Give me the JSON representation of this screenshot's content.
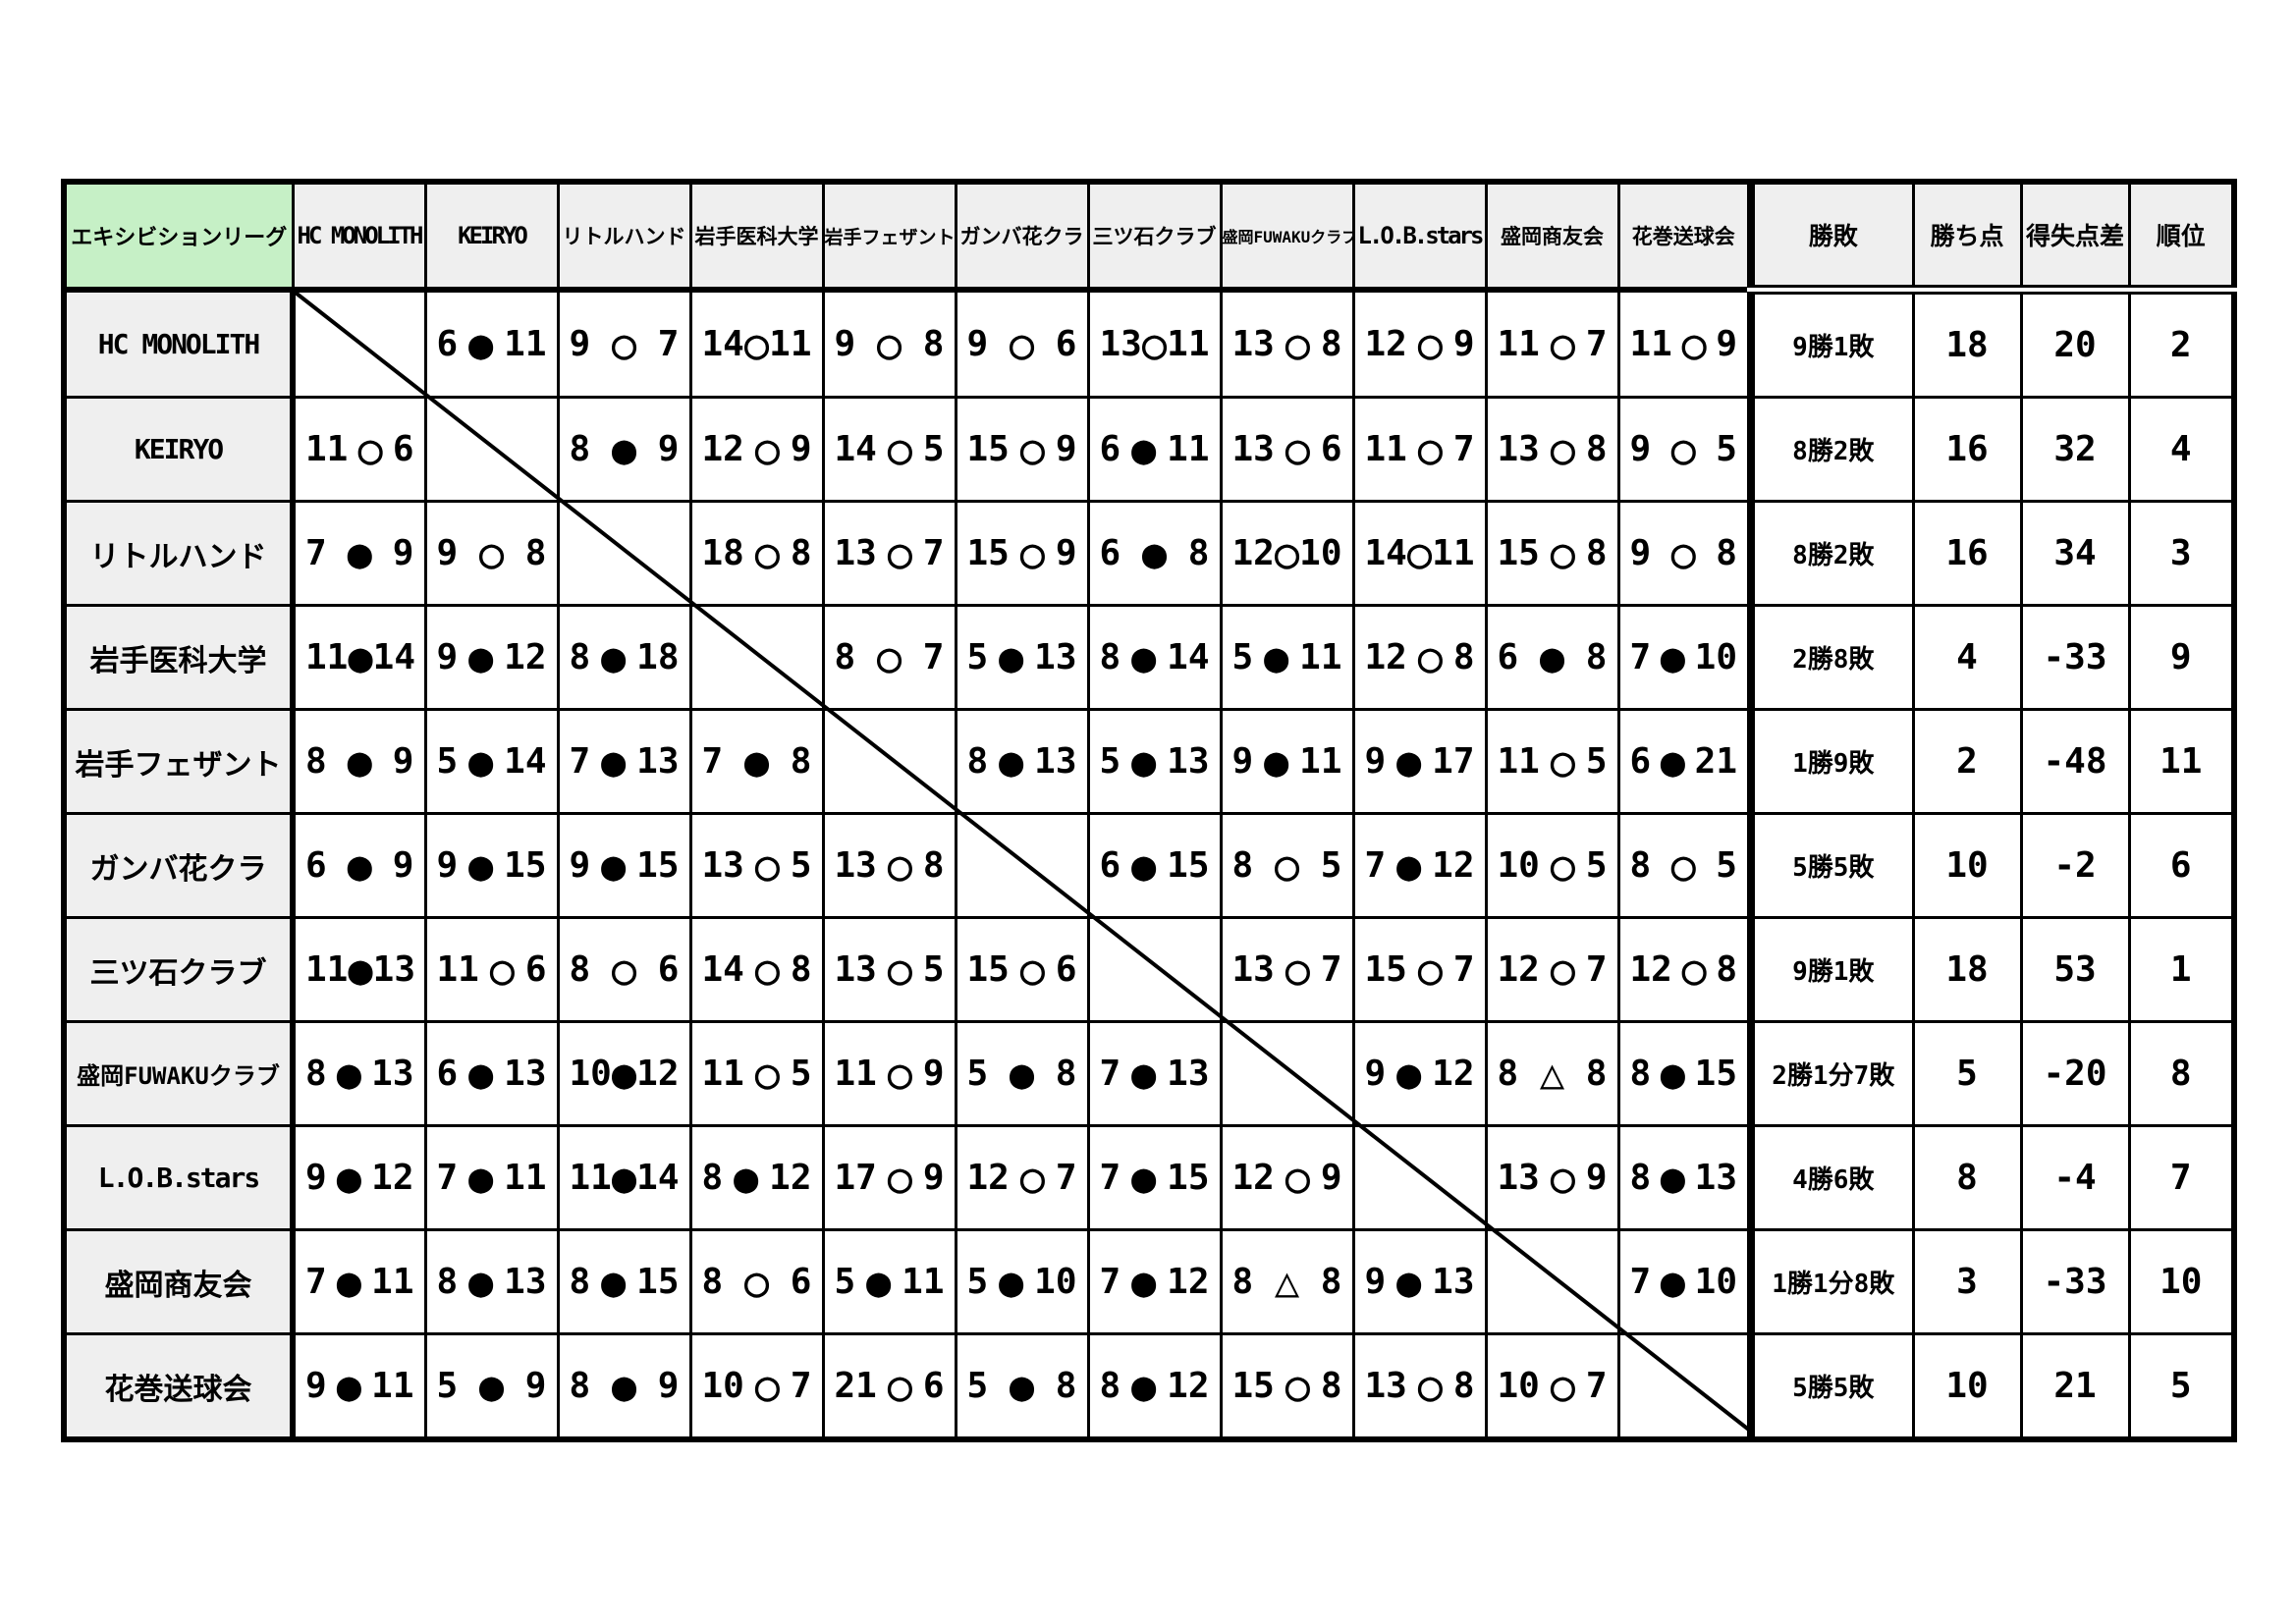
{
  "league": {
    "title": "エキシビションリーグ"
  },
  "summary_columns": [
    "勝敗",
    "勝ち点",
    "得失点差",
    "順位"
  ],
  "marks": {
    "win": "○",
    "lose": "●",
    "draw": "△"
  },
  "teams": [
    {
      "name": "HC MONOLITH",
      "results": [
        null,
        {
          "left": "6",
          "mark": "●",
          "right": "11"
        },
        {
          "left": "9",
          "mark": "○",
          "right": "7"
        },
        {
          "left": "14",
          "mark": "○",
          "right": "11"
        },
        {
          "left": "9",
          "mark": "○",
          "right": "8"
        },
        {
          "left": "9",
          "mark": "○",
          "right": "6"
        },
        {
          "left": "13",
          "mark": "○",
          "right": "11"
        },
        {
          "left": "13",
          "mark": "○",
          "right": "8"
        },
        {
          "left": "12",
          "mark": "○",
          "right": "9"
        },
        {
          "left": "11",
          "mark": "○",
          "right": "7"
        },
        {
          "left": "11",
          "mark": "○",
          "right": "9"
        }
      ],
      "record": "9勝1敗",
      "points": "18",
      "diff": "20",
      "rank": "2"
    },
    {
      "name": "KEIRYO",
      "results": [
        {
          "left": "11",
          "mark": "○",
          "right": "6"
        },
        null,
        {
          "left": "8",
          "mark": "●",
          "right": "9"
        },
        {
          "left": "12",
          "mark": "○",
          "right": "9"
        },
        {
          "left": "14",
          "mark": "○",
          "right": "5"
        },
        {
          "left": "15",
          "mark": "○",
          "right": "9"
        },
        {
          "left": "6",
          "mark": "●",
          "right": "11"
        },
        {
          "left": "13",
          "mark": "○",
          "right": "6"
        },
        {
          "left": "11",
          "mark": "○",
          "right": "7"
        },
        {
          "left": "13",
          "mark": "○",
          "right": "8"
        },
        {
          "left": "9",
          "mark": "○",
          "right": "5"
        }
      ],
      "record": "8勝2敗",
      "points": "16",
      "diff": "32",
      "rank": "4"
    },
    {
      "name": "リトルハンド",
      "results": [
        {
          "left": "7",
          "mark": "●",
          "right": "9"
        },
        {
          "left": "9",
          "mark": "○",
          "right": "8"
        },
        null,
        {
          "left": "18",
          "mark": "○",
          "right": "8"
        },
        {
          "left": "13",
          "mark": "○",
          "right": "7"
        },
        {
          "left": "15",
          "mark": "○",
          "right": "9"
        },
        {
          "left": "6",
          "mark": "●",
          "right": "8"
        },
        {
          "left": "12",
          "mark": "○",
          "right": "10"
        },
        {
          "left": "14",
          "mark": "○",
          "right": "11"
        },
        {
          "left": "15",
          "mark": "○",
          "right": "8"
        },
        {
          "left": "9",
          "mark": "○",
          "right": "8"
        }
      ],
      "record": "8勝2敗",
      "points": "16",
      "diff": "34",
      "rank": "3"
    },
    {
      "name": "岩手医科大学",
      "results": [
        {
          "left": "11",
          "mark": "●",
          "right": "14"
        },
        {
          "left": "9",
          "mark": "●",
          "right": "12"
        },
        {
          "left": "8",
          "mark": "●",
          "right": "18"
        },
        null,
        {
          "left": "8",
          "mark": "○",
          "right": "7"
        },
        {
          "left": "5",
          "mark": "●",
          "right": "13"
        },
        {
          "left": "8",
          "mark": "●",
          "right": "14"
        },
        {
          "left": "5",
          "mark": "●",
          "right": "11"
        },
        {
          "left": "12",
          "mark": "○",
          "right": "8"
        },
        {
          "left": "6",
          "mark": "●",
          "right": "8"
        },
        {
          "left": "7",
          "mark": "●",
          "right": "10"
        }
      ],
      "record": "2勝8敗",
      "points": "4",
      "diff": "-33",
      "rank": "9"
    },
    {
      "name": "岩手フェザント",
      "results": [
        {
          "left": "8",
          "mark": "●",
          "right": "9"
        },
        {
          "left": "5",
          "mark": "●",
          "right": "14"
        },
        {
          "left": "7",
          "mark": "●",
          "right": "13"
        },
        {
          "left": "7",
          "mark": "●",
          "right": "8"
        },
        null,
        {
          "left": "8",
          "mark": "●",
          "right": "13"
        },
        {
          "left": "5",
          "mark": "●",
          "right": "13"
        },
        {
          "left": "9",
          "mark": "●",
          "right": "11"
        },
        {
          "left": "9",
          "mark": "●",
          "right": "17"
        },
        {
          "left": "11",
          "mark": "○",
          "right": "5"
        },
        {
          "left": "6",
          "mark": "●",
          "right": "21"
        }
      ],
      "record": "1勝9敗",
      "points": "2",
      "diff": "-48",
      "rank": "11"
    },
    {
      "name": "ガンバ花クラ",
      "results": [
        {
          "left": "6",
          "mark": "●",
          "right": "9"
        },
        {
          "left": "9",
          "mark": "●",
          "right": "15"
        },
        {
          "left": "9",
          "mark": "●",
          "right": "15"
        },
        {
          "left": "13",
          "mark": "○",
          "right": "5"
        },
        {
          "left": "13",
          "mark": "○",
          "right": "8"
        },
        null,
        {
          "left": "6",
          "mark": "●",
          "right": "15"
        },
        {
          "left": "8",
          "mark": "○",
          "right": "5"
        },
        {
          "left": "7",
          "mark": "●",
          "right": "12"
        },
        {
          "left": "10",
          "mark": "○",
          "right": "5"
        },
        {
          "left": "8",
          "mark": "○",
          "right": "5"
        }
      ],
      "record": "5勝5敗",
      "points": "10",
      "diff": "-2",
      "rank": "6"
    },
    {
      "name": "三ツ石クラブ",
      "results": [
        {
          "left": "11",
          "mark": "●",
          "right": "13"
        },
        {
          "left": "11",
          "mark": "○",
          "right": "6"
        },
        {
          "left": "8",
          "mark": "○",
          "right": "6"
        },
        {
          "left": "14",
          "mark": "○",
          "right": "8"
        },
        {
          "left": "13",
          "mark": "○",
          "right": "5"
        },
        {
          "left": "15",
          "mark": "○",
          "right": "6"
        },
        null,
        {
          "left": "13",
          "mark": "○",
          "right": "7"
        },
        {
          "left": "15",
          "mark": "○",
          "right": "7"
        },
        {
          "left": "12",
          "mark": "○",
          "right": "7"
        },
        {
          "left": "12",
          "mark": "○",
          "right": "8"
        }
      ],
      "record": "9勝1敗",
      "points": "18",
      "diff": "53",
      "rank": "1"
    },
    {
      "name": "盛岡FUWAKUクラブ",
      "results": [
        {
          "left": "8",
          "mark": "●",
          "right": "13"
        },
        {
          "left": "6",
          "mark": "●",
          "right": "13"
        },
        {
          "left": "10",
          "mark": "●",
          "right": "12"
        },
        {
          "left": "11",
          "mark": "○",
          "right": "5"
        },
        {
          "left": "11",
          "mark": "○",
          "right": "9"
        },
        {
          "left": "5",
          "mark": "●",
          "right": "8"
        },
        {
          "left": "7",
          "mark": "●",
          "right": "13"
        },
        null,
        {
          "left": "9",
          "mark": "●",
          "right": "12"
        },
        {
          "left": "8",
          "mark": "△",
          "right": "8"
        },
        {
          "left": "8",
          "mark": "●",
          "right": "15"
        }
      ],
      "record": "2勝1分7敗",
      "points": "5",
      "diff": "-20",
      "rank": "8"
    },
    {
      "name": "L.O.B.stars",
      "results": [
        {
          "left": "9",
          "mark": "●",
          "right": "12"
        },
        {
          "left": "7",
          "mark": "●",
          "right": "11"
        },
        {
          "left": "11",
          "mark": "●",
          "right": "14"
        },
        {
          "left": "8",
          "mark": "●",
          "right": "12"
        },
        {
          "left": "17",
          "mark": "○",
          "right": "9"
        },
        {
          "left": "12",
          "mark": "○",
          "right": "7"
        },
        {
          "left": "7",
          "mark": "●",
          "right": "15"
        },
        {
          "left": "12",
          "mark": "○",
          "right": "9"
        },
        null,
        {
          "left": "13",
          "mark": "○",
          "right": "9"
        },
        {
          "left": "8",
          "mark": "●",
          "right": "13"
        }
      ],
      "record": "4勝6敗",
      "points": "8",
      "diff": "-4",
      "rank": "7"
    },
    {
      "name": "盛岡商友会",
      "results": [
        {
          "left": "7",
          "mark": "●",
          "right": "11"
        },
        {
          "left": "8",
          "mark": "●",
          "right": "13"
        },
        {
          "left": "8",
          "mark": "●",
          "right": "15"
        },
        {
          "left": "8",
          "mark": "○",
          "right": "6"
        },
        {
          "left": "5",
          "mark": "●",
          "right": "11"
        },
        {
          "left": "5",
          "mark": "●",
          "right": "10"
        },
        {
          "left": "7",
          "mark": "●",
          "right": "12"
        },
        {
          "left": "8",
          "mark": "△",
          "right": "8"
        },
        {
          "left": "9",
          "mark": "●",
          "right": "13"
        },
        null,
        {
          "left": "7",
          "mark": "●",
          "right": "10"
        }
      ],
      "record": "1勝1分8敗",
      "points": "3",
      "diff": "-33",
      "rank": "10"
    },
    {
      "name": "花巻送球会",
      "results": [
        {
          "left": "9",
          "mark": "●",
          "right": "11"
        },
        {
          "left": "5",
          "mark": "●",
          "right": "9"
        },
        {
          "left": "8",
          "mark": "●",
          "right": "9"
        },
        {
          "left": "10",
          "mark": "○",
          "right": "7"
        },
        {
          "left": "21",
          "mark": "○",
          "right": "6"
        },
        {
          "left": "5",
          "mark": "●",
          "right": "8"
        },
        {
          "left": "8",
          "mark": "●",
          "right": "12"
        },
        {
          "left": "15",
          "mark": "○",
          "right": "8"
        },
        {
          "left": "13",
          "mark": "○",
          "right": "8"
        },
        {
          "left": "10",
          "mark": "○",
          "right": "7"
        },
        null
      ],
      "record": "5勝5敗",
      "points": "10",
      "diff": "21",
      "rank": "5"
    }
  ]
}
